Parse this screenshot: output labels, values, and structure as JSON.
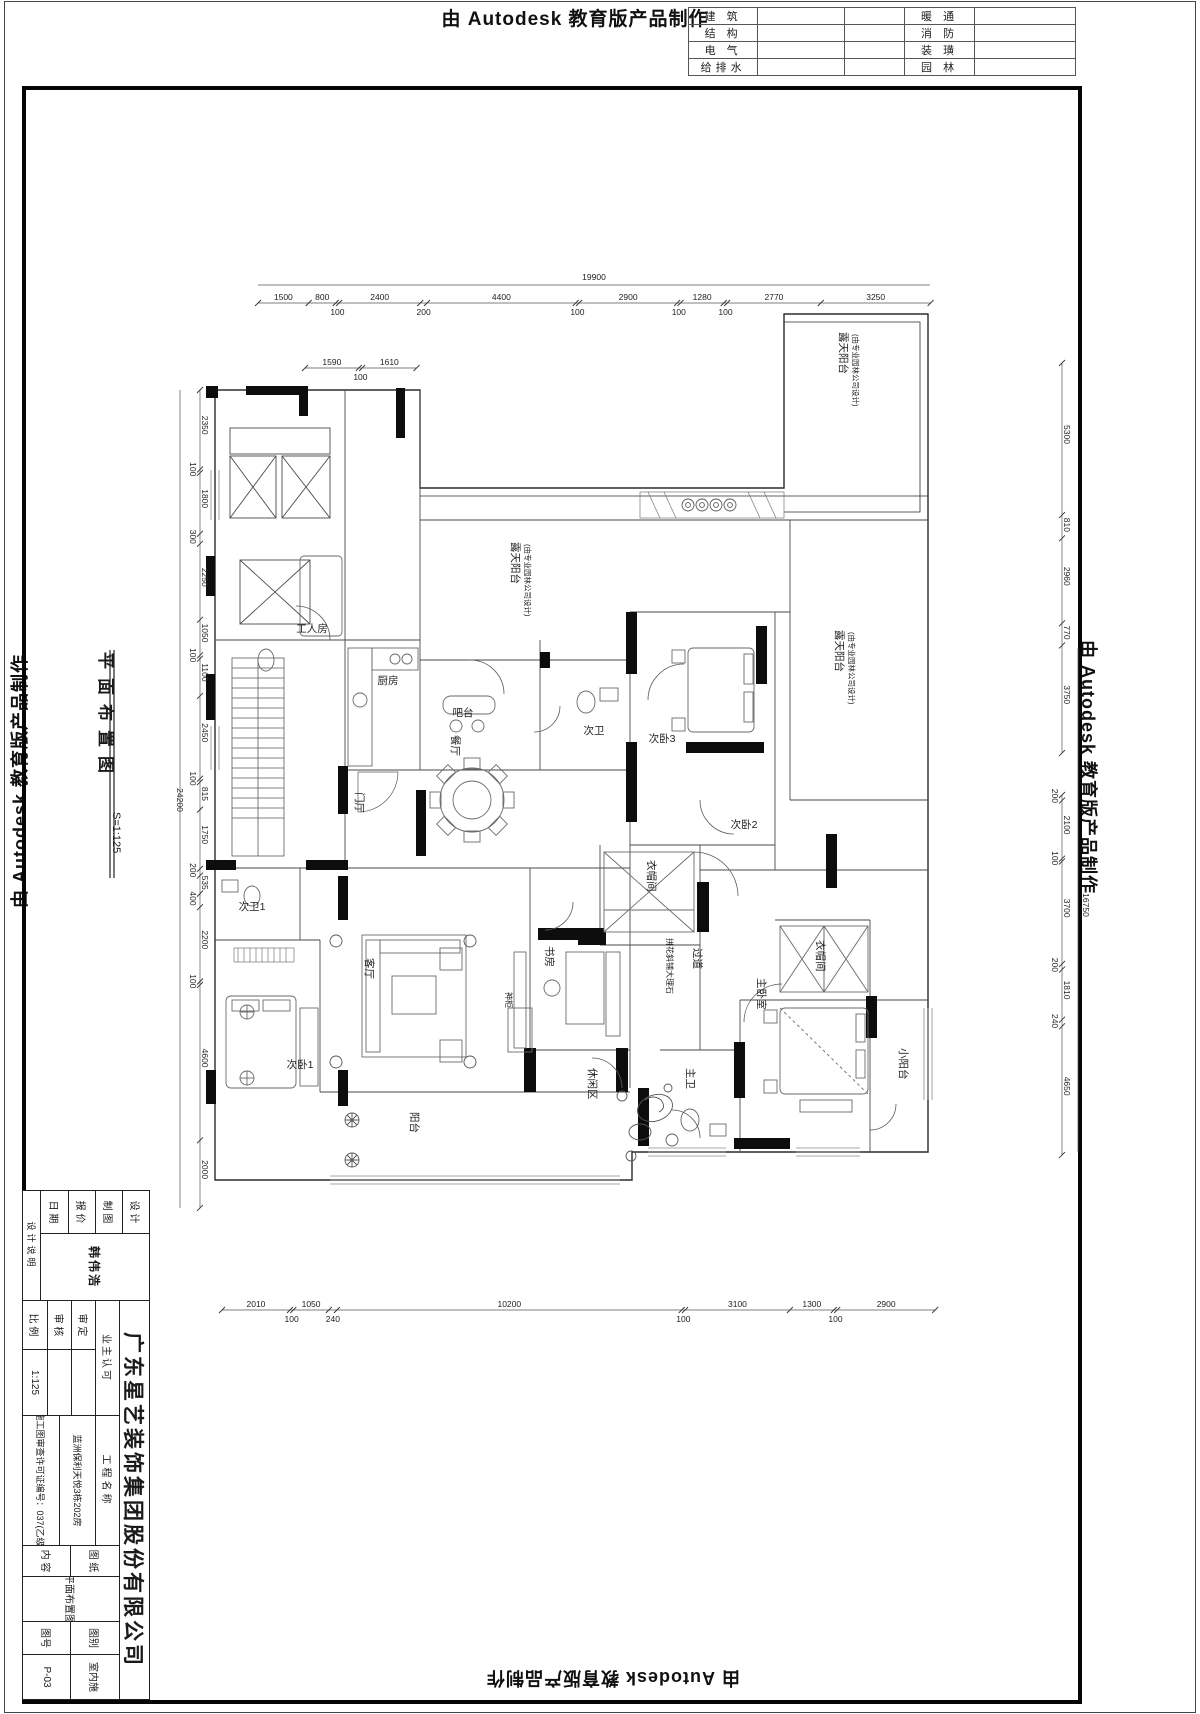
{
  "edge_banners": {
    "top": "由 Autodesk 教育版产品制作",
    "left": "由 Autodesk 教育版产品制作",
    "right": "由 Autodesk 教育版产品制作",
    "bottom": "由 Autodesk 教育版产品制作"
  },
  "discipline_table": {
    "rows": [
      {
        "l": "建 筑",
        "r": "暖 通"
      },
      {
        "l": "结 构",
        "r": "消 防"
      },
      {
        "l": "电 气",
        "r": "装 璜"
      },
      {
        "l": "给排水",
        "r": "园 林"
      }
    ]
  },
  "drawing_title": {
    "name": "平面布置图",
    "scale": "S=1:125"
  },
  "plan": {
    "rooms": [
      {
        "t": "露天阳台",
        "x": 840,
        "y": 332,
        "v": 1
      },
      {
        "t": "(由专业园林公司设计)",
        "x": 853,
        "y": 334,
        "v": 1,
        "s": 7.5
      },
      {
        "t": "露天阳台",
        "x": 512,
        "y": 542,
        "v": 1
      },
      {
        "t": "(由专业园林公司设计)",
        "x": 525,
        "y": 544,
        "v": 1,
        "s": 7.5
      },
      {
        "t": "露天阳台",
        "x": 836,
        "y": 630,
        "v": 1
      },
      {
        "t": "(由专业园林公司设计)",
        "x": 849,
        "y": 632,
        "v": 1,
        "s": 7.5
      },
      {
        "t": "工人房",
        "x": 312,
        "y": 632
      },
      {
        "t": "厨房",
        "x": 388,
        "y": 684
      },
      {
        "t": "吧台",
        "x": 463,
        "y": 716
      },
      {
        "t": "餐厅",
        "x": 452,
        "y": 735,
        "v": 1
      },
      {
        "t": "次卫",
        "x": 594,
        "y": 734
      },
      {
        "t": "次卧3",
        "x": 662,
        "y": 742
      },
      {
        "t": "门厅",
        "x": 356,
        "y": 792,
        "v": 1
      },
      {
        "t": "次卧2",
        "x": 744,
        "y": 828
      },
      {
        "t": "衣帽间",
        "x": 648,
        "y": 860,
        "v": 1
      },
      {
        "t": "过道",
        "x": 694,
        "y": 948,
        "v": 1
      },
      {
        "t": "拼花斜铺大理石",
        "x": 667,
        "y": 938,
        "v": 1,
        "s": 8
      },
      {
        "t": "次卫1",
        "x": 252,
        "y": 910
      },
      {
        "t": "客厅",
        "x": 366,
        "y": 958,
        "v": 1
      },
      {
        "t": "书房",
        "x": 546,
        "y": 946,
        "v": 1
      },
      {
        "t": "神柜",
        "x": 506,
        "y": 992,
        "v": 1,
        "s": 8
      },
      {
        "t": "次卧1",
        "x": 300,
        "y": 1068
      },
      {
        "t": "休闲区",
        "x": 589,
        "y": 1068,
        "v": 1
      },
      {
        "t": "阳台",
        "x": 411,
        "y": 1112,
        "v": 1
      },
      {
        "t": "主卫",
        "x": 687,
        "y": 1068,
        "v": 1
      },
      {
        "t": "主卧室",
        "x": 758,
        "y": 978,
        "v": 1
      },
      {
        "t": "衣帽间",
        "x": 817,
        "y": 940,
        "v": 1
      },
      {
        "t": "小阳台",
        "x": 900,
        "y": 1048,
        "v": 1
      }
    ],
    "dims": {
      "totals": [
        {
          "label": "19900",
          "dir": "h",
          "x1": 258,
          "y1": 285,
          "x2": 930,
          "lx": 594,
          "ly": 280
        },
        {
          "label": "24200",
          "dir": "v",
          "x1": 180,
          "y1": 390,
          "y2": 1208,
          "lx": 177,
          "ly": 800
        },
        {
          "label": "16750",
          "dir": "v",
          "x1": 1078,
          "y1": 648,
          "y2": 1152,
          "lx": 1083,
          "ly": 905
        }
      ],
      "runs": [
        {
          "dir": "h",
          "x": 258,
          "y": 303,
          "scale": 0.0338,
          "values": [
            1500,
            800,
            100,
            2400,
            200,
            4400,
            100,
            2900,
            100,
            1280,
            100,
            2770,
            3250
          ]
        },
        {
          "dir": "h",
          "x": 305,
          "y": 368,
          "scale": 0.0338,
          "values": [
            1590,
            100,
            1610
          ]
        },
        {
          "dir": "v",
          "x": 200,
          "y": 390,
          "scale": 0.0338,
          "values": [
            2350,
            100,
            1800,
            300,
            2250,
            1050,
            100,
            1100,
            2450,
            100,
            815,
            1750,
            200,
            535,
            400,
            2200,
            100,
            4600,
            2000
          ]
        },
        {
          "dir": "h",
          "x": 222,
          "y": 1310,
          "scale": 0.0338,
          "values": [
            2010,
            100,
            1050,
            240,
            10200,
            100,
            3100,
            1300,
            100,
            2900
          ]
        },
        {
          "dir": "v",
          "x": 1062,
          "y": 363,
          "scale": 0.0287,
          "values": [
            5300,
            810,
            2960,
            770,
            3750
          ]
        },
        {
          "dir": "v",
          "x": 1062,
          "y": 795,
          "scale": 0.0277,
          "values": [
            200,
            2100,
            100,
            3700,
            200,
            1810,
            240,
            4650
          ]
        }
      ]
    }
  },
  "title_block": {
    "design_note": "设计说明",
    "left_rows": [
      [
        "设 计",
        ""
      ],
      [
        "制 图",
        "韩伟浩"
      ],
      [
        "报 价",
        ""
      ],
      [
        "日 期",
        ""
      ]
    ],
    "owner_header": "业主认可",
    "mid_rows": [
      [
        "审 定",
        ""
      ],
      [
        "审 核",
        ""
      ],
      [
        "比 例",
        "1:125"
      ]
    ],
    "company": "广东星艺装饰集团股份有限公司",
    "project_label": "工程名称",
    "project_value": "蓝洲保利天悦3栋202房",
    "permit": "施工图审查许可证编号：037(乙级)",
    "sheet_label_1": "图 纸",
    "sheet_label_2": "内 容",
    "sheet_value": "平面布置图",
    "cat_label": "图别",
    "cat_value": "室内施",
    "no_label": "图号",
    "no_value": "P-03"
  }
}
